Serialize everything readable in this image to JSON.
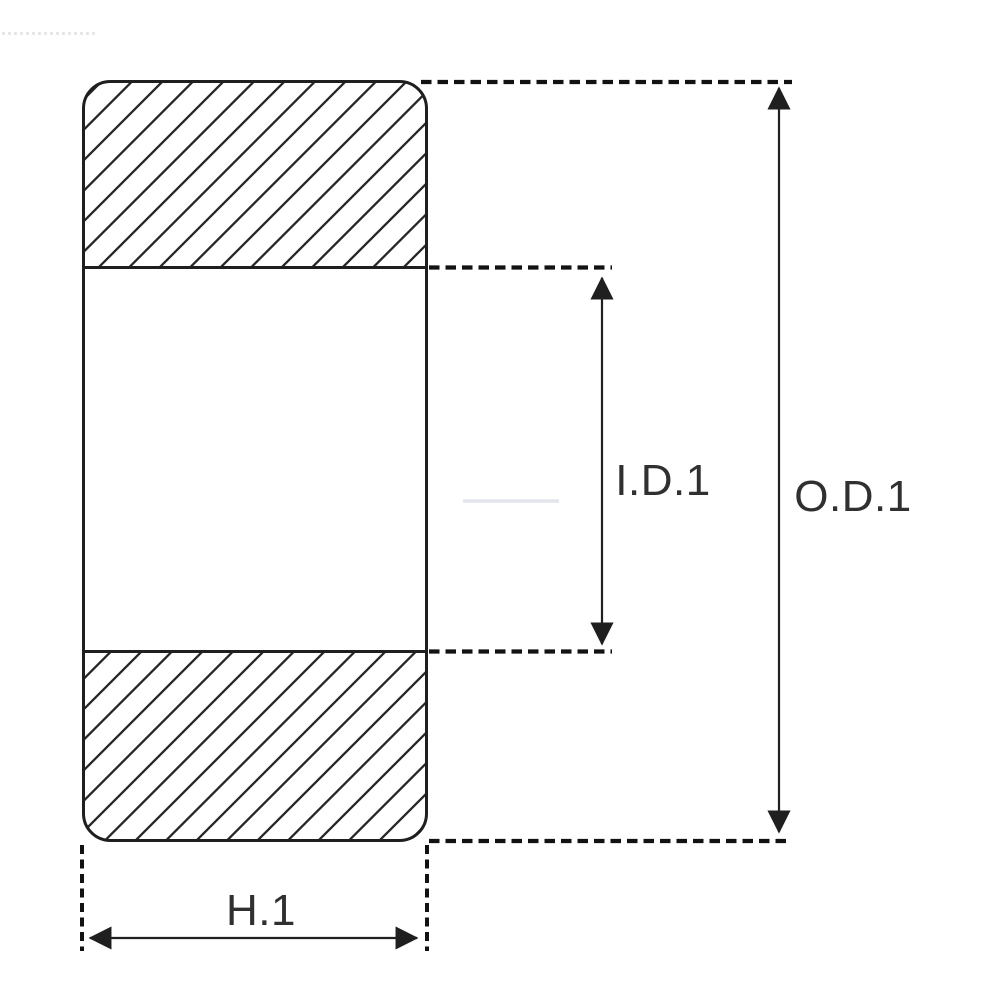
{
  "diagram": {
    "kind": "bearing-cross-section-dimension-drawing",
    "labels": {
      "inner_diameter": "I.D.1",
      "outer_diameter": "O.D.1",
      "height": "H.1"
    },
    "colors": {
      "line": "#1f1f1f",
      "hatch": "#262626",
      "dash": "#121212",
      "dimension": "#202020",
      "text": "#303030",
      "background": "#ffffff",
      "artifact": "#dee2e8"
    }
  }
}
